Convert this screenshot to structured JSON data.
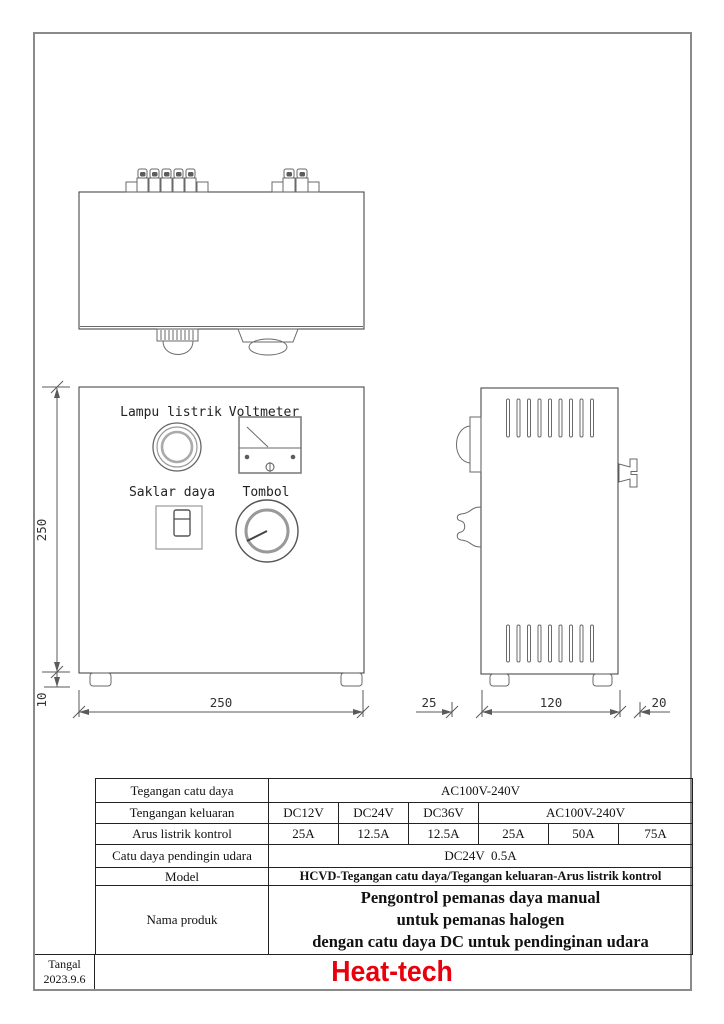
{
  "page": {
    "background": "#ffffff",
    "frame_color": "#8a8a8a"
  },
  "drawing": {
    "front": {
      "lamp_label": "Lampu listrik",
      "voltmeter_label": "Voltmeter",
      "switch_label": "Saklar daya",
      "knob_label": "Tombol"
    },
    "dims": {
      "front_height": "250",
      "feet_height": "10",
      "front_width": "250",
      "side_left": "25",
      "side_depth": "120",
      "side_right": "20"
    }
  },
  "spec_table": {
    "rows": [
      {
        "label": "Tegangan catu daya",
        "value": "AC100V-240V"
      },
      {
        "label": "Tengangan keluaran",
        "values": [
          "DC12V",
          "DC24V",
          "DC36V",
          "AC100V-240V"
        ]
      },
      {
        "label": "Arus listrik kontrol",
        "values": [
          "25A",
          "12.5A",
          "12.5A",
          "25A",
          "50A",
          "75A"
        ]
      },
      {
        "label": "Catu daya pendingin udara",
        "value": "DC24V  0.5A"
      },
      {
        "label": "Model",
        "value": "HCVD-Tegangan catu daya/Tegangan keluaran-Arus listrik kontrol"
      },
      {
        "label": "Nama produk",
        "lines": [
          "Pengontrol pemanas daya manual",
          "untuk pemanas halogen",
          "dengan catu daya DC untuk pendinginan udara"
        ]
      }
    ]
  },
  "title_block": {
    "date_label": "Tangal",
    "date_value": "2023.9.6",
    "brand": "Heat-tech",
    "brand_color": "#e8000d"
  }
}
